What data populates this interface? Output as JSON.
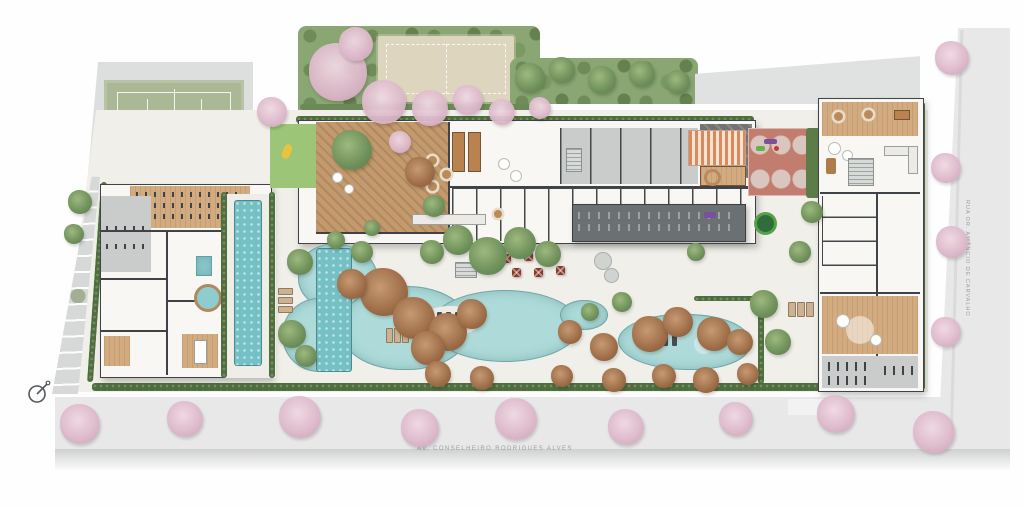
{
  "scene": {
    "kind": "architectural-site-plan",
    "compass_icon": "north-arrow-icon"
  },
  "streets": {
    "bottom": {
      "label": "AV. CONSELHEIRO RODRIGUES ALVES"
    },
    "right": {
      "label": "RUA DR. AMÂNCIO DE CARVALHO"
    }
  },
  "areas": [
    "tennis-court",
    "beach-volleyball-court",
    "kids-playground",
    "play-court",
    "wellness-gym-building",
    "lap-pool",
    "plunge-pool",
    "hot-tub",
    "massage-room",
    "wood-deck-lounge",
    "gourmet-hall",
    "central-amenities-building",
    "covered-fitness-pavilion",
    "leisure-pool",
    "pool-lap-lane",
    "sun-deck",
    "dining-terrace-umbrellas",
    "fire-pit-lounge",
    "right-amenities-building",
    "bike-room",
    "gardens",
    "street-trees",
    "access-ramp"
  ],
  "palette": {
    "background": "#fefefe",
    "road": "#e7e8e7",
    "site_paving": "#f0efe9",
    "roof_gray": "#e0e2e1",
    "wall_dark": "#3f4347",
    "wood": "#d2ab80",
    "tennis_green": "#aab896",
    "sand": "#ded5be",
    "pool_light": "#aedbda",
    "pool_dark": "#74c0c4",
    "hedge_green": "#4f6e3d",
    "tree_green": "#6f905a",
    "tree_russet": "#9c6c47",
    "blossom_pink": "#ddb8ca",
    "court_red": "#c27d6f",
    "umbrella_red": "#8a392c",
    "label_gray": "#9ba0a3"
  }
}
